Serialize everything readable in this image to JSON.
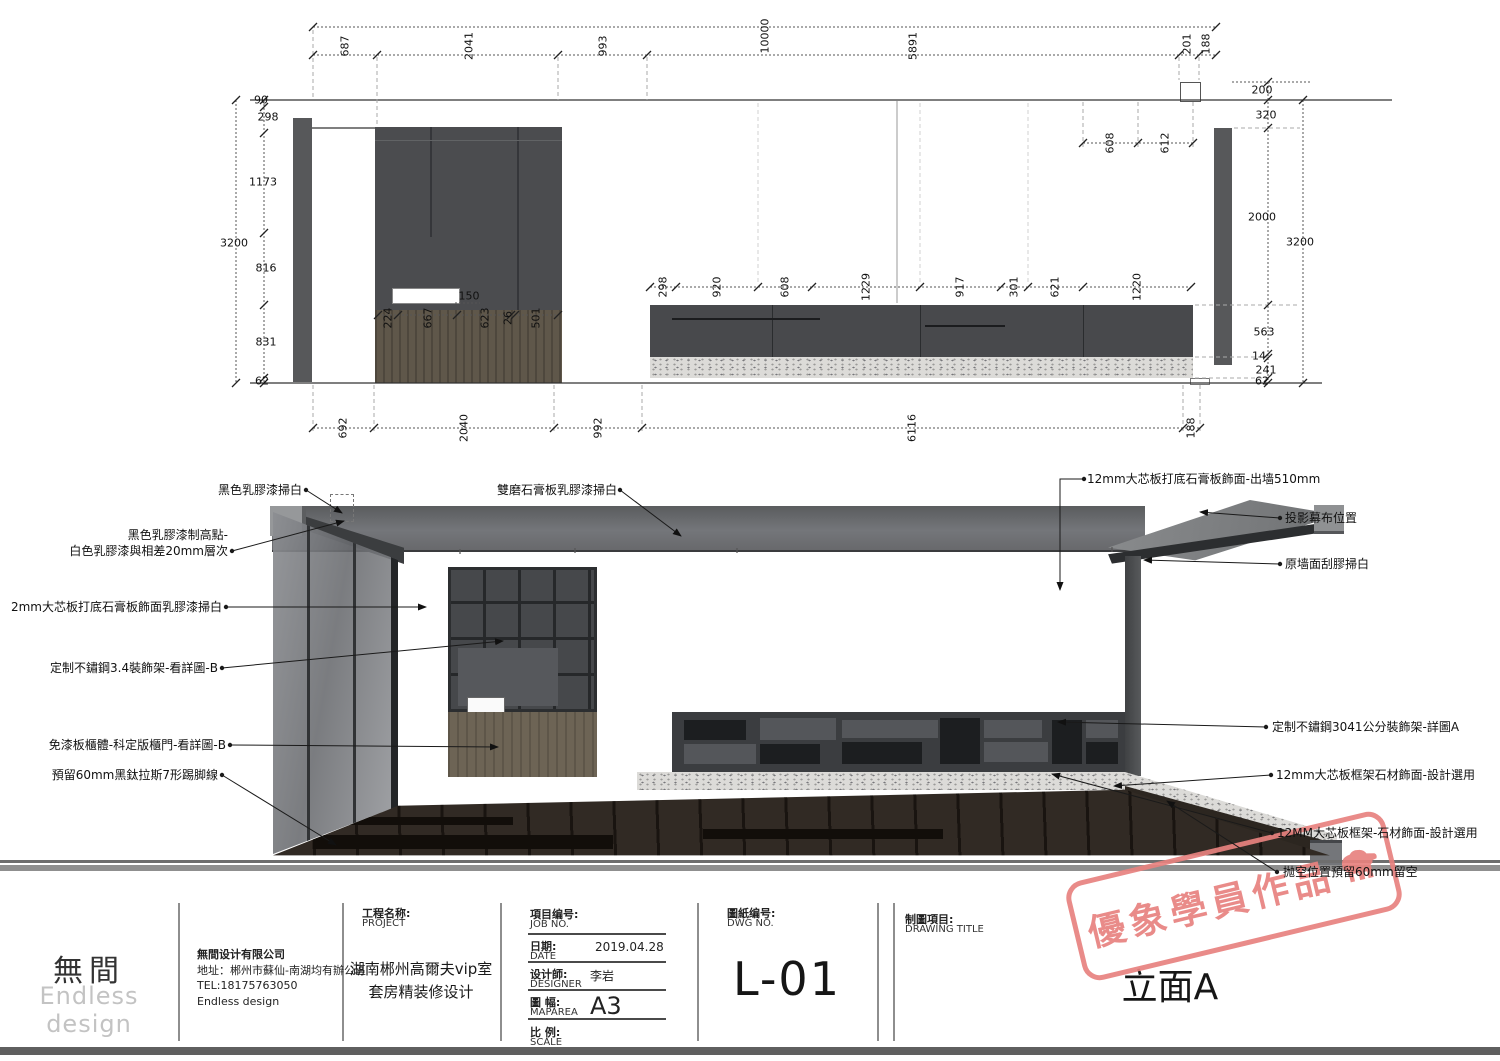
{
  "drawing": {
    "dims": {
      "top_overall": "10000",
      "top_row": [
        "687",
        "2041",
        "993",
        "5891",
        "201",
        "188"
      ],
      "left_overall": "3200",
      "left_chain": [
        "90",
        "298",
        "1173",
        "816",
        "831",
        "62"
      ],
      "counter_dim": "150",
      "left_cabinet_row": [
        "224",
        "667",
        "623",
        "26",
        "501"
      ],
      "right_cabinet_row": [
        "298",
        "920",
        "608",
        "1229",
        "917",
        "301",
        "621",
        "1220"
      ],
      "soffit_row": [
        "608",
        "612"
      ],
      "right_overall": "3200",
      "right_chain": [
        "200",
        "320",
        "2000",
        "563",
        "14",
        "241",
        "62"
      ],
      "bottom_row": [
        "692",
        "2040",
        "992",
        "6116",
        "188"
      ]
    }
  },
  "callouts": {
    "top": "雙磨石膏板乳膠漆掃白",
    "left": [
      "黑色乳膠漆掃白",
      "黑色乳膠漆制高點-",
      "白色乳膠漆與相差20mm層次",
      "2mm大芯板打底石膏板飾面乳膠漆掃白",
      "定制不鏽鋼3.4裝飾架-看詳圖-B",
      "免漆板櫃體-科定版櫃門-看詳圖-B",
      "預留60mm黑鈦拉斯7形踢脚線"
    ],
    "right": [
      "12mm大芯板打底石膏板飾面-出墙510mm",
      "投影幕布位置",
      "原墙面刮膠掃白",
      "定制不鏽鋼3041公分裝飾架-詳圖A",
      "12mm大芯板框架石材飾面-設計選用",
      "12MM大芯板框架-石材飾面-設計選用",
      "抛空位置預留60mm留空"
    ]
  },
  "title_block": {
    "logo": {
      "cn": "無間",
      "en": "Endless design"
    },
    "company": {
      "line1": "無間设计有限公司",
      "line2": "地址：郴州市蘇仙-南湖均有辦公區",
      "line3": "TEL:18175763050",
      "line4": "Endless design"
    },
    "project": {
      "label_cn": "工程名称:",
      "label_en": "PROJECT",
      "name_line1": "湖南郴州高爾夫vip室",
      "name_line2": "套房精装修设计"
    },
    "meta_rows": [
      {
        "cn": "項目编号:",
        "en": "JOB NO.",
        "value": ""
      },
      {
        "cn": "日期:",
        "en": "DATE",
        "value": "2019.04.28"
      },
      {
        "cn": "设计師:",
        "en": "DESIGNER",
        "value": "李岩"
      },
      {
        "cn": "圖 幅:",
        "en": "MAPAREA",
        "value": "A3"
      },
      {
        "cn": "比 例:",
        "en": "SCALE",
        "value": ""
      }
    ],
    "dwg": {
      "label_cn": "圖紙编号:",
      "label_en": "DWG NO.",
      "value": "L-01"
    },
    "drawing_title": {
      "label_cn": "制圖項目:",
      "label_en": "DRAWING TITLE",
      "value": "立面A"
    }
  },
  "stamp": {
    "text": "優象學員作品",
    "color": "#e8827f"
  },
  "colors": {
    "line": "#333333",
    "panel_dark": "#46484b",
    "wood": "#6d6455",
    "stone": "#dcdbd8",
    "stamp_red": "#e8827f"
  }
}
